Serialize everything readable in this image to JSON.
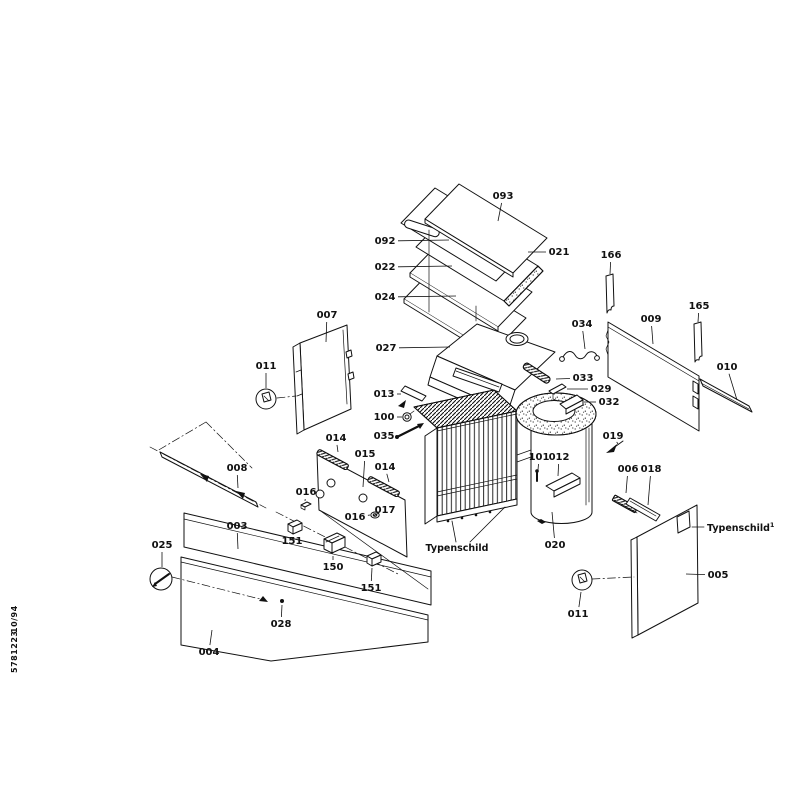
{
  "document": {
    "type": "exploded-parts-diagram",
    "footer_code": "5781223",
    "footer_date": "10/94"
  },
  "annotations": {
    "typenschild_center": "Typenschild",
    "typenschild_right": "Typenschild",
    "typenschild_right_sup": "1"
  },
  "callouts": [
    {
      "id": "093",
      "x": 503,
      "y": 196,
      "lx": 498,
      "ly": 221
    },
    {
      "id": "092",
      "x": 385,
      "y": 241,
      "lx": 449,
      "ly": 240
    },
    {
      "id": "021",
      "x": 559,
      "y": 252,
      "lx": 528,
      "ly": 252
    },
    {
      "id": "022",
      "x": 385,
      "y": 267,
      "lx": 452,
      "ly": 266
    },
    {
      "id": "024",
      "x": 385,
      "y": 297,
      "lx": 456,
      "ly": 296
    },
    {
      "id": "166",
      "x": 611,
      "y": 255,
      "lx": 610,
      "ly": 274
    },
    {
      "id": "009",
      "x": 651,
      "y": 319,
      "lx": 653,
      "ly": 344
    },
    {
      "id": "165",
      "x": 699,
      "y": 306,
      "lx": 698,
      "ly": 322
    },
    {
      "id": "007",
      "x": 327,
      "y": 315,
      "lx": 326,
      "ly": 342
    },
    {
      "id": "034",
      "x": 582,
      "y": 324,
      "lx": 585,
      "ly": 349
    },
    {
      "id": "027",
      "x": 386,
      "y": 348,
      "lx": 450,
      "ly": 347
    },
    {
      "id": "010",
      "x": 727,
      "y": 367,
      "lx": 737,
      "ly": 400
    },
    {
      "id": "011",
      "x": 266,
      "y": 366,
      "lx": 266,
      "ly": 388
    },
    {
      "id": "033",
      "x": 583,
      "y": 378,
      "lx": 556,
      "ly": 379
    },
    {
      "id": "029",
      "x": 601,
      "y": 389,
      "lx": 567,
      "ly": 389
    },
    {
      "id": "013",
      "x": 384,
      "y": 394,
      "lx": 401,
      "ly": 394
    },
    {
      "id": "032",
      "x": 609,
      "y": 402,
      "lx": 584,
      "ly": 402
    },
    {
      "id": "100",
      "x": 384,
      "y": 417,
      "lx": 402,
      "ly": 417
    },
    {
      "id": "035",
      "x": 384,
      "y": 436,
      "lx": 396,
      "ly": 436
    },
    {
      "id": "019",
      "x": 613,
      "y": 436,
      "lx": 618,
      "ly": 444
    },
    {
      "id": "014",
      "x": 336,
      "y": 438,
      "lx": 338,
      "ly": 452
    },
    {
      "id": "015",
      "x": 365,
      "y": 454,
      "lx": 363,
      "ly": 487
    },
    {
      "id": "014",
      "x": 385,
      "y": 467,
      "lx": 389,
      "ly": 482
    },
    {
      "id": "101",
      "x": 539,
      "y": 457,
      "lx": 538,
      "ly": 470
    },
    {
      "id": "012",
      "x": 559,
      "y": 457,
      "lx": 558,
      "ly": 476
    },
    {
      "id": "008",
      "x": 237,
      "y": 468,
      "lx": 238,
      "ly": 488
    },
    {
      "id": "006",
      "x": 628,
      "y": 469,
      "lx": 626,
      "ly": 493
    },
    {
      "id": "018",
      "x": 651,
      "y": 469,
      "lx": 648,
      "ly": 505
    },
    {
      "id": "016",
      "x": 306,
      "y": 492,
      "lx": 305,
      "ly": 501
    },
    {
      "id": "017",
      "x": 385,
      "y": 510,
      "lx": 379,
      "ly": 513
    },
    {
      "id": "016",
      "x": 355,
      "y": 517,
      "lx": 370,
      "ly": 515
    },
    {
      "id": "003",
      "x": 237,
      "y": 526,
      "lx": 238,
      "ly": 549
    },
    {
      "id": "151",
      "x": 292,
      "y": 541,
      "lx": 293,
      "ly": 534
    },
    {
      "id": "025",
      "x": 162,
      "y": 545,
      "lx": 162,
      "ly": 567
    },
    {
      "id": "020",
      "x": 555,
      "y": 545,
      "lx": 552,
      "ly": 512
    },
    {
      "id": "150",
      "x": 333,
      "y": 567,
      "lx": 333,
      "ly": 556
    },
    {
      "id": "005",
      "x": 718,
      "y": 575,
      "lx": 686,
      "ly": 574
    },
    {
      "id": "151",
      "x": 371,
      "y": 588,
      "lx": 372,
      "ly": 568
    },
    {
      "id": "011",
      "x": 578,
      "y": 614,
      "lx": 581,
      "ly": 592
    },
    {
      "id": "028",
      "x": 281,
      "y": 624,
      "lx": 282,
      "ly": 605
    },
    {
      "id": "004",
      "x": 209,
      "y": 652,
      "lx": 212,
      "ly": 630
    }
  ]
}
